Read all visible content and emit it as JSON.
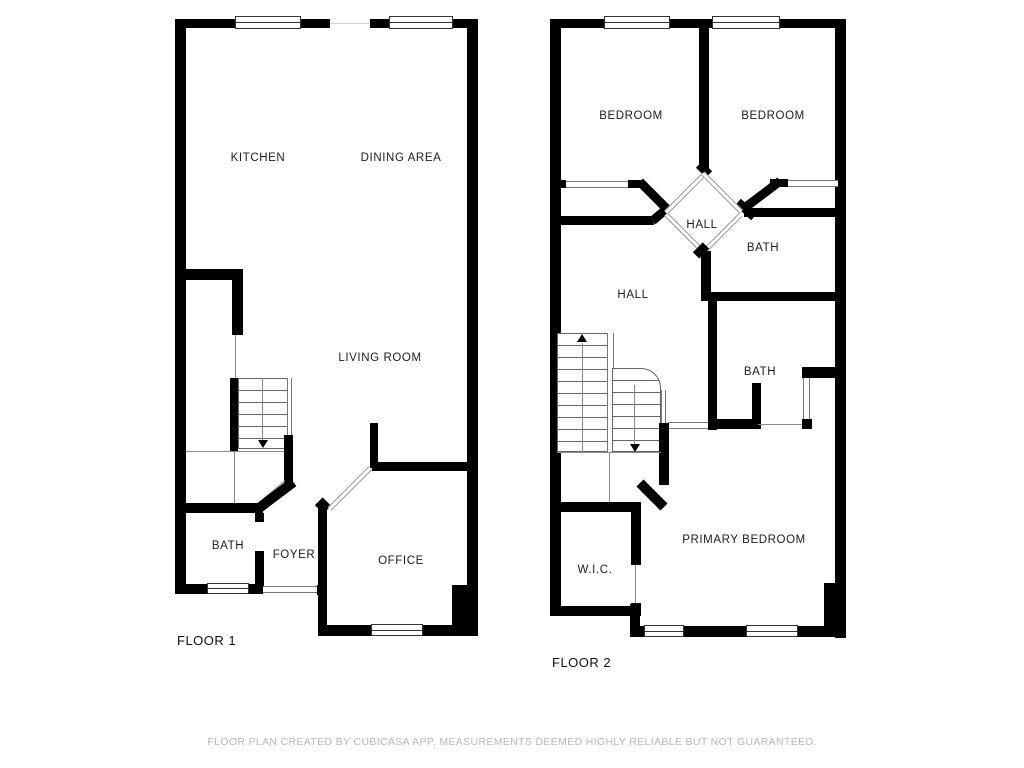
{
  "floor1": {
    "title": "FLOOR 1",
    "rooms": {
      "kitchen": "KITCHEN",
      "dining": "DINING AREA",
      "living": "LIVING ROOM",
      "bath": "BATH",
      "foyer": "FOYER",
      "office": "OFFICE"
    }
  },
  "floor2": {
    "title": "FLOOR 2",
    "rooms": {
      "bedroom_left": "BEDROOM",
      "bedroom_right": "BEDROOM",
      "hall_upper": "HALL",
      "bath_upper": "BATH",
      "hall": "HALL",
      "bath_lower": "BATH",
      "wic": "W.I.C.",
      "primary": "PRIMARY BEDROOM"
    }
  },
  "footer": {
    "disclaimer": "FLOOR PLAN CREATED BY CUBICASA APP. MEASUREMENTS DEEMED HIGHLY RELIABLE BUT NOT GUARANTEED."
  },
  "colors": {
    "wall": "#000000",
    "thin_line": "#8a8a8a",
    "text": "#1c1c1c",
    "footer_text": "#b9b9b9",
    "background": "#ffffff"
  }
}
